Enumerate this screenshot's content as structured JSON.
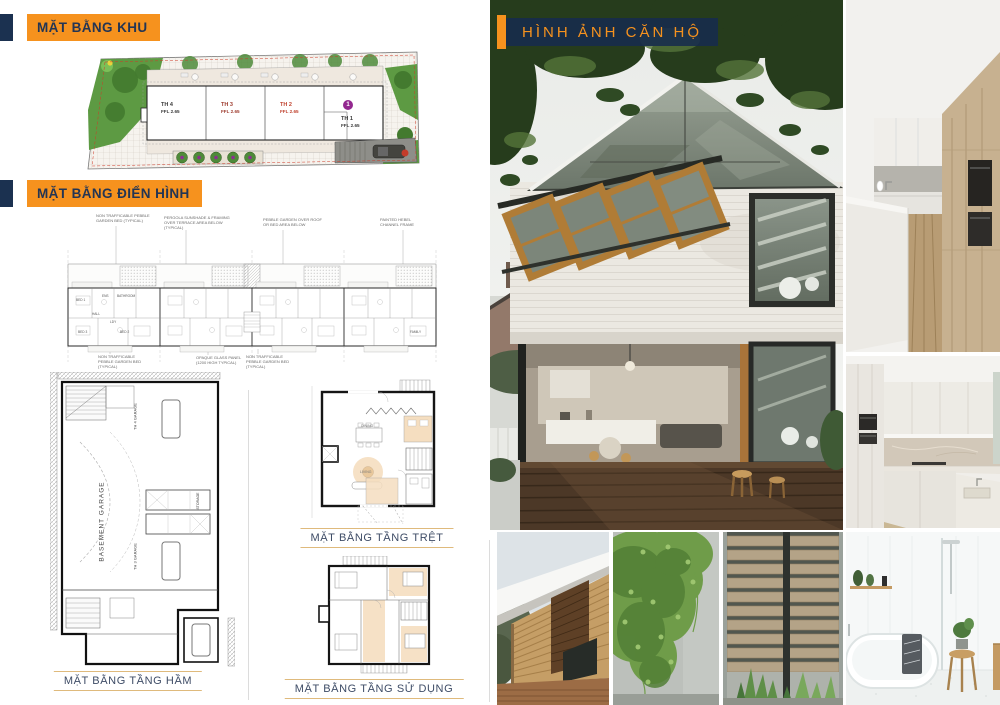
{
  "theme": {
    "accent_orange": "#F6921E",
    "navy": "#1B3150",
    "caption_text": "#3E4C66",
    "caption_line": "#DFBA7C",
    "site_red": "#CF3A28",
    "marker_purple": "#93278F"
  },
  "titles": {
    "site": "MẶT BẰNG KHU",
    "typical": "MẶT BẰNG ĐIỂN HÌNH",
    "photos": "HÌNH ẢNH CĂN HỘ"
  },
  "captions": {
    "basement": "MẶT BẰNG TẦNG HẦM",
    "ground": "MẶT BẰNG TẦNG TRỆT",
    "upper": "MẶT BẰNG TẦNG SỬ DỤNG"
  },
  "site_plan": {
    "units": [
      {
        "name": "TH 4",
        "level": "FFL 2.65"
      },
      {
        "name": "TH 3",
        "level": "FFL 2.65"
      },
      {
        "name": "TH 2",
        "level": "FFL 2.65"
      },
      {
        "name": "TH 1",
        "level": "FFL 2.65"
      }
    ],
    "unit_marker": "1"
  },
  "typical_plan": {
    "notes_top": [
      "NON TRAFFICABLE PEBBLE GARDEN BED (TYPICAL)",
      "PERGOLA SUNSHADE & FRAMING OVER TERRACE AREA BELOW (TYPICAL)",
      "PEBBLE GARDEN OVER ROOF OR BED AREA BELOW",
      "PAINTED HEBEL CHANNEL FRAME"
    ],
    "notes_bottom": [
      "NON TRAFFICABLE PEBBLE GARDEN BED (TYPICAL)",
      "OPAQUE GLASS PANEL (1200 HIGH TYPICAL)",
      "NON TRAFFICABLE PEBBLE GARDEN BED (TYPICAL)"
    ],
    "rooms": {
      "bed1": "BED 1",
      "ens": "ENS",
      "bathroom": "BATHROOM",
      "hall": "HALL",
      "ldy": "LDY",
      "bed3": "BED 3",
      "bed2": "BED 2",
      "family": "FAMILY"
    }
  },
  "basement_plan": {
    "area": "BASEMENT GARAGE",
    "garage_a": "TH 4 GARAGE",
    "garage_b": "TH 3 GARAGE",
    "storage": "STORAGE"
  },
  "ground_plan": {
    "dining": "DINING",
    "living": "LIVING"
  }
}
